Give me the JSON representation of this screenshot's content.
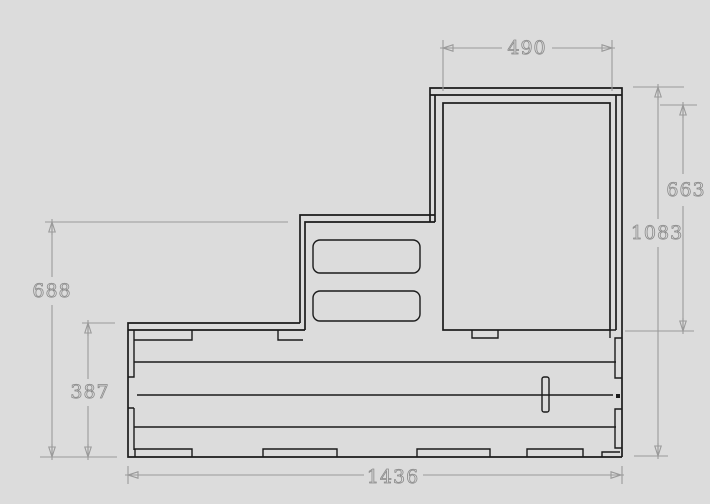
{
  "window": {
    "background_color": "#dcdcdc"
  },
  "drawing": {
    "type": "technical-elevation-drawing",
    "stroke_color": "#1b1b1b",
    "dimension_color": "#9a9a9a",
    "dimensions": {
      "top_width": "490",
      "right_door_height": "663",
      "right_total_height": "1083",
      "left_upper_height": "688",
      "left_lower_height": "387",
      "bottom_total_width": "1436"
    }
  }
}
